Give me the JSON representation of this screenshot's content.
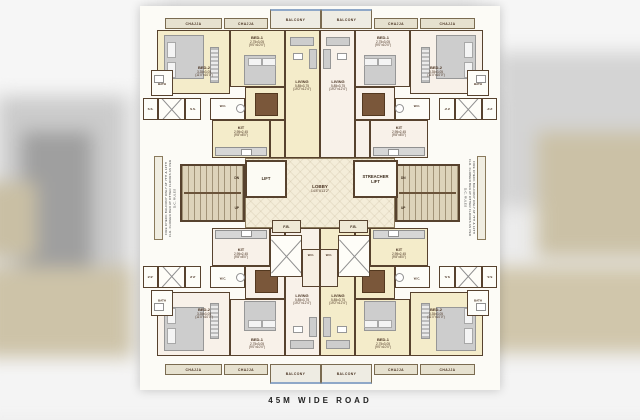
{
  "road_label": "45M WIDE ROAD",
  "strips": {
    "chajja": "CHAJJA",
    "balcony": "BALCONY"
  },
  "core": {
    "lift": "LIFT",
    "stretcher_lift": "STREACHER LIFT",
    "lobby": "LOBBY",
    "lobby_dim": "14'8\"X13'2\"",
    "fb": "F.B.",
    "wc": "W.C.",
    "up": "UP",
    "dn": "DN",
    "ss": "S.S."
  },
  "side_note_left": "FIRE CHECK BALCONY ONLY AT 7TH & 12TH FLR. FLOWER BED AT OTHER FLOORS AS PER D.C. RULES",
  "side_note_right": "FIRE CHECK BALCONY ONLY AT 7TH & 12TH FLR. FLOWER BED AT OTHER FLOORS AS PER D.C. RULES",
  "rooms": {
    "bed1": {
      "name": "BED-1",
      "dim_m": "2.75x3.05",
      "dim_ft": "(9'0\"x10'0\")"
    },
    "bed2": {
      "name": "BED-2",
      "dim_m": "3.35x3.05",
      "dim_ft": "(11'0\"x10'0\")"
    },
    "living": {
      "name": "LIVING",
      "dim_m": "5.85x3.75",
      "dim_ft": "(19'2\"x12'4\")"
    },
    "kit": {
      "name": "KIT",
      "dim_m": "2.95x2.45",
      "dim_ft": "(9'8\"x8'0\")"
    },
    "bath": {
      "name": "BATH"
    },
    "wc": {
      "name": "W.C."
    }
  },
  "colors": {
    "flat_cream": "#f4ecca",
    "flat_blush": "#f8f1e9",
    "wall": "#57422e",
    "balcony_edge": "#8fa8c8"
  }
}
